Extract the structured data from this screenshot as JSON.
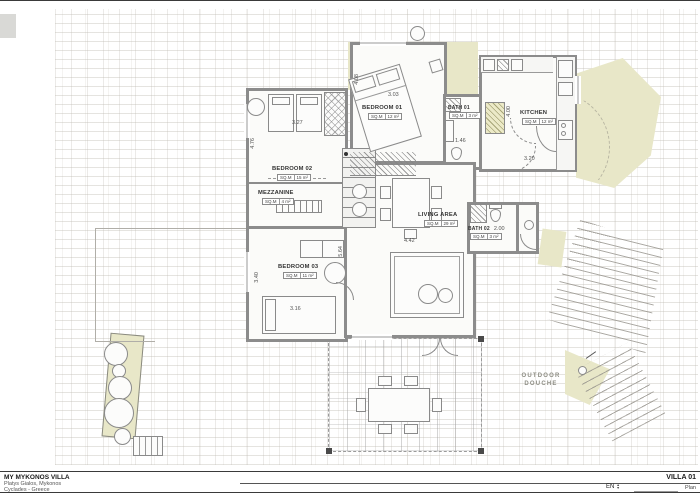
{
  "labels": {
    "sqm": "SQ.M"
  },
  "drawing": {
    "rooms": {
      "bedroom01": {
        "name": "BEDROOM 01",
        "area": "12 m²",
        "dim_w": "3.03",
        "dim_h": "4.08"
      },
      "bedroom02": {
        "name": "BEDROOM 02",
        "area": "15 m²",
        "dim_w": "3.27",
        "dim_h": "4.76"
      },
      "mezzanine": {
        "name": "MEZZANINE",
        "area": "4 m²"
      },
      "bedroom03": {
        "name": "BEDROOM 03",
        "area": "11 m²",
        "dim_w": "3.16",
        "dim_h": "3.40"
      },
      "living": {
        "name": "LIVING AREA",
        "area": "29 m²",
        "dim_w": "4.42",
        "dim_h": "5.64"
      },
      "kitchen": {
        "name": "KITCHEN",
        "area": "12 m²",
        "dim_w": "3.20",
        "dim_h": "4.00"
      },
      "bath01": {
        "name": "BATH 01",
        "area": "3 m²",
        "dim_w": "1.46"
      },
      "bath02": {
        "name": "BATH 02",
        "area": "3 m²",
        "dim_w": "2.00"
      }
    },
    "annotations": {
      "outdoor_douche_line1": "OUTDOOR",
      "outdoor_douche_line2": "DOUCHE"
    }
  },
  "title_block": {
    "project": "MY MYKONOS VILLA",
    "address1": "Platys Gialos, Mykonos",
    "address2": "Cyclades - Greece",
    "sheet_title": "VILLA 01",
    "sheet_subtitle": "Plan",
    "language": "EN"
  },
  "colors": {
    "planting": "#e8e7c8",
    "wall": "#8c8c8c",
    "annotation_gray": "#8e8e85"
  }
}
